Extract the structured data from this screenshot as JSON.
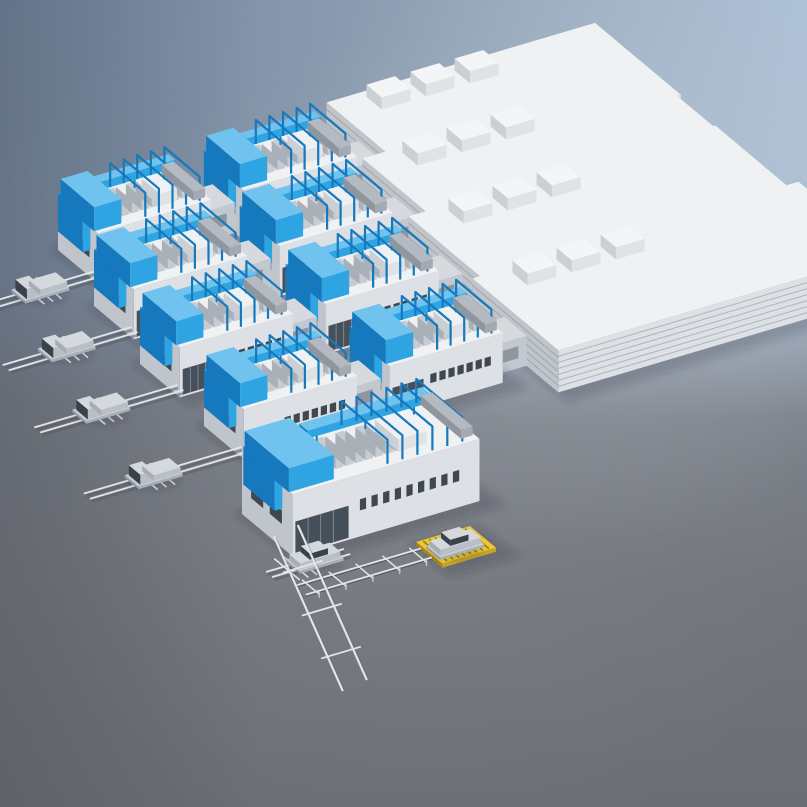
{
  "scene": {
    "canvas": {
      "width": 807,
      "height": 807
    },
    "projection": {
      "u_angle_deg": -16.5,
      "v_angle_deg": 40
    },
    "palette": {
      "backdrop_top_left": "#72839b",
      "backdrop_top_mid": "#8fa0b4",
      "backdrop_top_right": "#b0c3d8",
      "floor": "#74777e",
      "floor_dark": "#6b6e74",
      "building_top": "#eff1f3",
      "building_front": "#dde1e5",
      "building_side": "#bfc5cb",
      "building_dark": "#a8aeb6",
      "connector_top": "#d6dade",
      "connector_front": "#c2c8cf",
      "connector_side": "#aab1b9",
      "glass": "#46505a",
      "window": "#3f474f",
      "equip_blue": "#2ea4e2",
      "equip_blue_dark": "#1679bd",
      "equip_blue_light": "#6fc3ee",
      "cabinet_light": "#eef0f2",
      "cabinet_gray": "#c6ccd2",
      "cabinet_side": "#aab0b8",
      "unit_top": "#b4bac1",
      "unit_front": "#a3aab2",
      "unit_side": "#8f969e",
      "rail_light": "#e3e6e9",
      "rail_shadow": "#565a61",
      "corrugation": "rgba(130,138,148,0.5)",
      "vehicle_body": "#d5d9de",
      "vehicle_body_front": "#b9bfc7",
      "vehicle_body_side": "#a6adb5",
      "vehicle_glass": "#39414b",
      "carrier_top": "#c9ced4",
      "carrier_front": "#a9afb7",
      "carrier_side": "#949aa2",
      "platform_yellow": "#e9c832",
      "platform_yellow_front": "#c7a42a",
      "platform_yellow_side": "#a8871f",
      "platform_stripe": "rgba(70,60,18,0.55)",
      "shadow": "rgba(36,40,50,0.20)"
    },
    "objects_summary": {
      "production_lines": 5,
      "process_module_buildings": 9,
      "warehouse_buildings": 4,
      "rooftop_hvac_units_per_warehouse": 3,
      "conveyor_tracks": 6,
      "pickup_trucks": 4,
      "sedan_cars": 2,
      "vehicle_lift_platforms": 1
    },
    "rows": [
      {
        "name": "production-line-1",
        "origin": [
          58,
          250
        ],
        "module": {
          "len": 118,
          "w": 52,
          "h": 50
        },
        "modules": 2,
        "conn_len": 34,
        "warehouse": {
          "u0": 304,
          "len": 280,
          "w": 112,
          "h": 42,
          "v_off": -30,
          "rooftop_units": 3
        },
        "rail": {
          "v": 42,
          "from": -110,
          "to": 8,
          "cross": -52
        },
        "vehicle": {
          "type": "pickup-truck",
          "u": -52
        }
      },
      {
        "name": "production-line-2",
        "origin": [
          94,
          306
        ],
        "module": {
          "len": 118,
          "w": 52,
          "h": 50
        },
        "modules": 2,
        "conn_len": 34,
        "warehouse": {
          "u0": 304,
          "len": 300,
          "w": 112,
          "h": 42,
          "v_off": -30,
          "rooftop_units": 3
        },
        "rail": {
          "v": 42,
          "from": -125,
          "to": 8,
          "cross": -62
        },
        "vehicle": {
          "type": "pickup-truck",
          "u": -62
        }
      },
      {
        "name": "production-line-3",
        "origin": [
          140,
          364
        ],
        "module": {
          "len": 118,
          "w": 52,
          "h": 50
        },
        "modules": 2,
        "conn_len": 34,
        "warehouse": {
          "u0": 304,
          "len": 320,
          "w": 112,
          "h": 42,
          "v_off": -30,
          "rooftop_units": 3
        },
        "rail": {
          "v": 42,
          "from": -140,
          "to": 8,
          "cross": -74
        },
        "vehicle": {
          "type": "pickup-truck",
          "u": -74
        }
      },
      {
        "name": "production-line-4",
        "origin": [
          204,
          426
        ],
        "module": {
          "len": 118,
          "w": 52,
          "h": 50
        },
        "modules": 2,
        "conn_len": 34,
        "warehouse": {
          "u0": 304,
          "len": 340,
          "w": 112,
          "h": 42,
          "v_off": -30,
          "rooftop_units": 3
        },
        "rail": {
          "v": 42,
          "from": -155,
          "to": 8,
          "cross": -86
        },
        "vehicle": {
          "type": "pickup-truck",
          "u": -86
        }
      },
      {
        "name": "production-line-5",
        "origin": [
          242,
          514
        ],
        "module": {
          "len": 195,
          "w": 66,
          "h": 62
        },
        "modules": 1,
        "conn_len": 0,
        "warehouse": null,
        "rail": {
          "v": 80,
          "from": -35,
          "to": 45,
          "cross": -8
        },
        "vehicle": {
          "type": "sedan-car",
          "u": 12
        },
        "platform": {
          "u": 105,
          "v": 96,
          "len": 56,
          "w": 34,
          "car": "sedan-car"
        },
        "transfer": {
          "long_rails": 2,
          "long_rail_angle_deg": 66,
          "long_rail_len": 168,
          "cross_ticks": 3
        }
      }
    ]
  }
}
